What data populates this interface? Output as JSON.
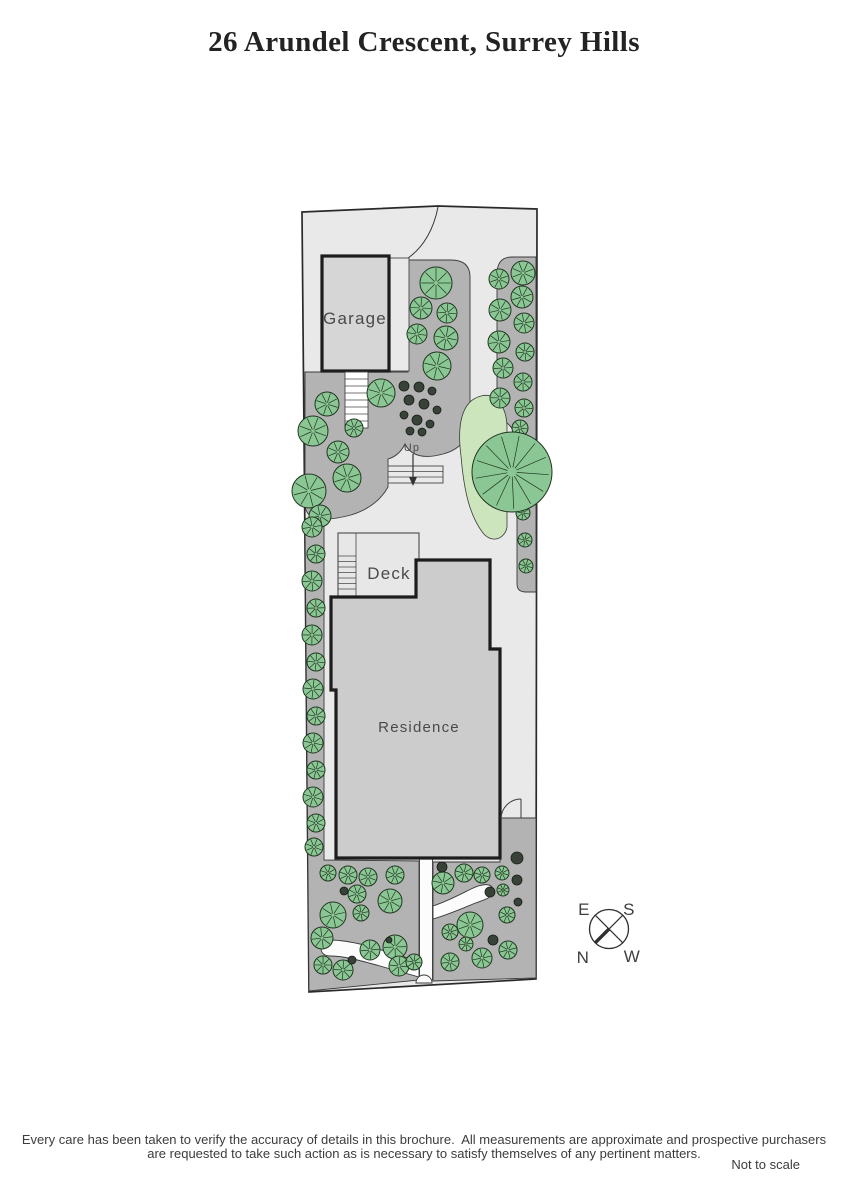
{
  "title": "26 Arundel Crescent, Surrey Hills",
  "plan": {
    "labels": {
      "garage": "Garage",
      "deck": "Deck",
      "residence": "Residence",
      "up": "Up"
    },
    "compass": {
      "east": "E",
      "south": "S",
      "north": "N",
      "west": "W"
    },
    "colors": {
      "site_fill": "#e9e9e9",
      "bed_fill": "#b3b3b3",
      "building_fill": "#d6d6d6",
      "residence_fill": "#cccccc",
      "deck_fill": "#e7e7e7",
      "outline": "#1d1d1d",
      "tree_fill": "#8bc795",
      "tree_stroke": "#20351f",
      "bush_fill": "#394239",
      "lawn_fill": "#cde5bd",
      "path_fill": "#fcfcfc"
    },
    "tree_format": "[x, y, radius]",
    "big_tree": [
      512,
      472,
      40
    ],
    "trees": [
      [
        436,
        283,
        16
      ],
      [
        421,
        308,
        11
      ],
      [
        447,
        313,
        10
      ],
      [
        417,
        334,
        10
      ],
      [
        446,
        338,
        12
      ],
      [
        437,
        366,
        14
      ],
      [
        381,
        393,
        14
      ],
      [
        327,
        404,
        12
      ],
      [
        313,
        431,
        15
      ],
      [
        338,
        452,
        11
      ],
      [
        354,
        428,
        9
      ],
      [
        347,
        478,
        14
      ],
      [
        309,
        491,
        17
      ],
      [
        320,
        516,
        11
      ],
      [
        312,
        527,
        10
      ],
      [
        316,
        554,
        9
      ],
      [
        312,
        581,
        10
      ],
      [
        316,
        608,
        9
      ],
      [
        312,
        635,
        10
      ],
      [
        316,
        662,
        9
      ],
      [
        313,
        689,
        10
      ],
      [
        316,
        716,
        9
      ],
      [
        313,
        743,
        10
      ],
      [
        316,
        770,
        9
      ],
      [
        313,
        797,
        10
      ],
      [
        316,
        823,
        9
      ],
      [
        314,
        847,
        9
      ],
      [
        523,
        273,
        12
      ],
      [
        499,
        279,
        10
      ],
      [
        522,
        297,
        11
      ],
      [
        500,
        310,
        11
      ],
      [
        524,
        323,
        10
      ],
      [
        499,
        342,
        11
      ],
      [
        525,
        352,
        9
      ],
      [
        503,
        368,
        10
      ],
      [
        523,
        382,
        9
      ],
      [
        500,
        398,
        10
      ],
      [
        524,
        408,
        9
      ],
      [
        520,
        428,
        8
      ],
      [
        523,
        513,
        7
      ],
      [
        525,
        540,
        7
      ],
      [
        526,
        566,
        7
      ],
      [
        328,
        873,
        8
      ],
      [
        348,
        875,
        9
      ],
      [
        368,
        877,
        9
      ],
      [
        395,
        875,
        9
      ],
      [
        357,
        894,
        9
      ],
      [
        390,
        901,
        12
      ],
      [
        333,
        915,
        13
      ],
      [
        361,
        913,
        8
      ],
      [
        322,
        938,
        11
      ],
      [
        370,
        950,
        10
      ],
      [
        395,
        947,
        12
      ],
      [
        323,
        965,
        9
      ],
      [
        343,
        970,
        10
      ],
      [
        399,
        966,
        10
      ],
      [
        414,
        962,
        8
      ],
      [
        443,
        883,
        11
      ],
      [
        464,
        873,
        9
      ],
      [
        482,
        875,
        8
      ],
      [
        502,
        873,
        7
      ],
      [
        503,
        890,
        6
      ],
      [
        507,
        915,
        8
      ],
      [
        470,
        925,
        13
      ],
      [
        450,
        932,
        8
      ],
      [
        508,
        950,
        9
      ],
      [
        482,
        958,
        10
      ],
      [
        450,
        962,
        9
      ],
      [
        466,
        944,
        7
      ]
    ],
    "bushes": [
      [
        404,
        386,
        5
      ],
      [
        419,
        387,
        5
      ],
      [
        432,
        391,
        4
      ],
      [
        409,
        400,
        5
      ],
      [
        424,
        404,
        5
      ],
      [
        437,
        410,
        4
      ],
      [
        404,
        415,
        4
      ],
      [
        417,
        420,
        5
      ],
      [
        430,
        424,
        4
      ],
      [
        410,
        431,
        4
      ],
      [
        422,
        432,
        4
      ],
      [
        517,
        858,
        6
      ],
      [
        517,
        880,
        5
      ],
      [
        518,
        902,
        4
      ],
      [
        344,
        891,
        4
      ],
      [
        352,
        960,
        4
      ],
      [
        389,
        940,
        3
      ],
      [
        442,
        867,
        5
      ],
      [
        490,
        892,
        5
      ],
      [
        493,
        940,
        5
      ]
    ]
  },
  "footer": {
    "line1": "Every care has been taken to verify the accuracy of details in this brochure.  All measurements are approximate and prospective purchasers",
    "line2": "are requested to take such action as is necessary to satisfy themselves of any pertinent matters.",
    "scale_note": "Not to scale"
  }
}
